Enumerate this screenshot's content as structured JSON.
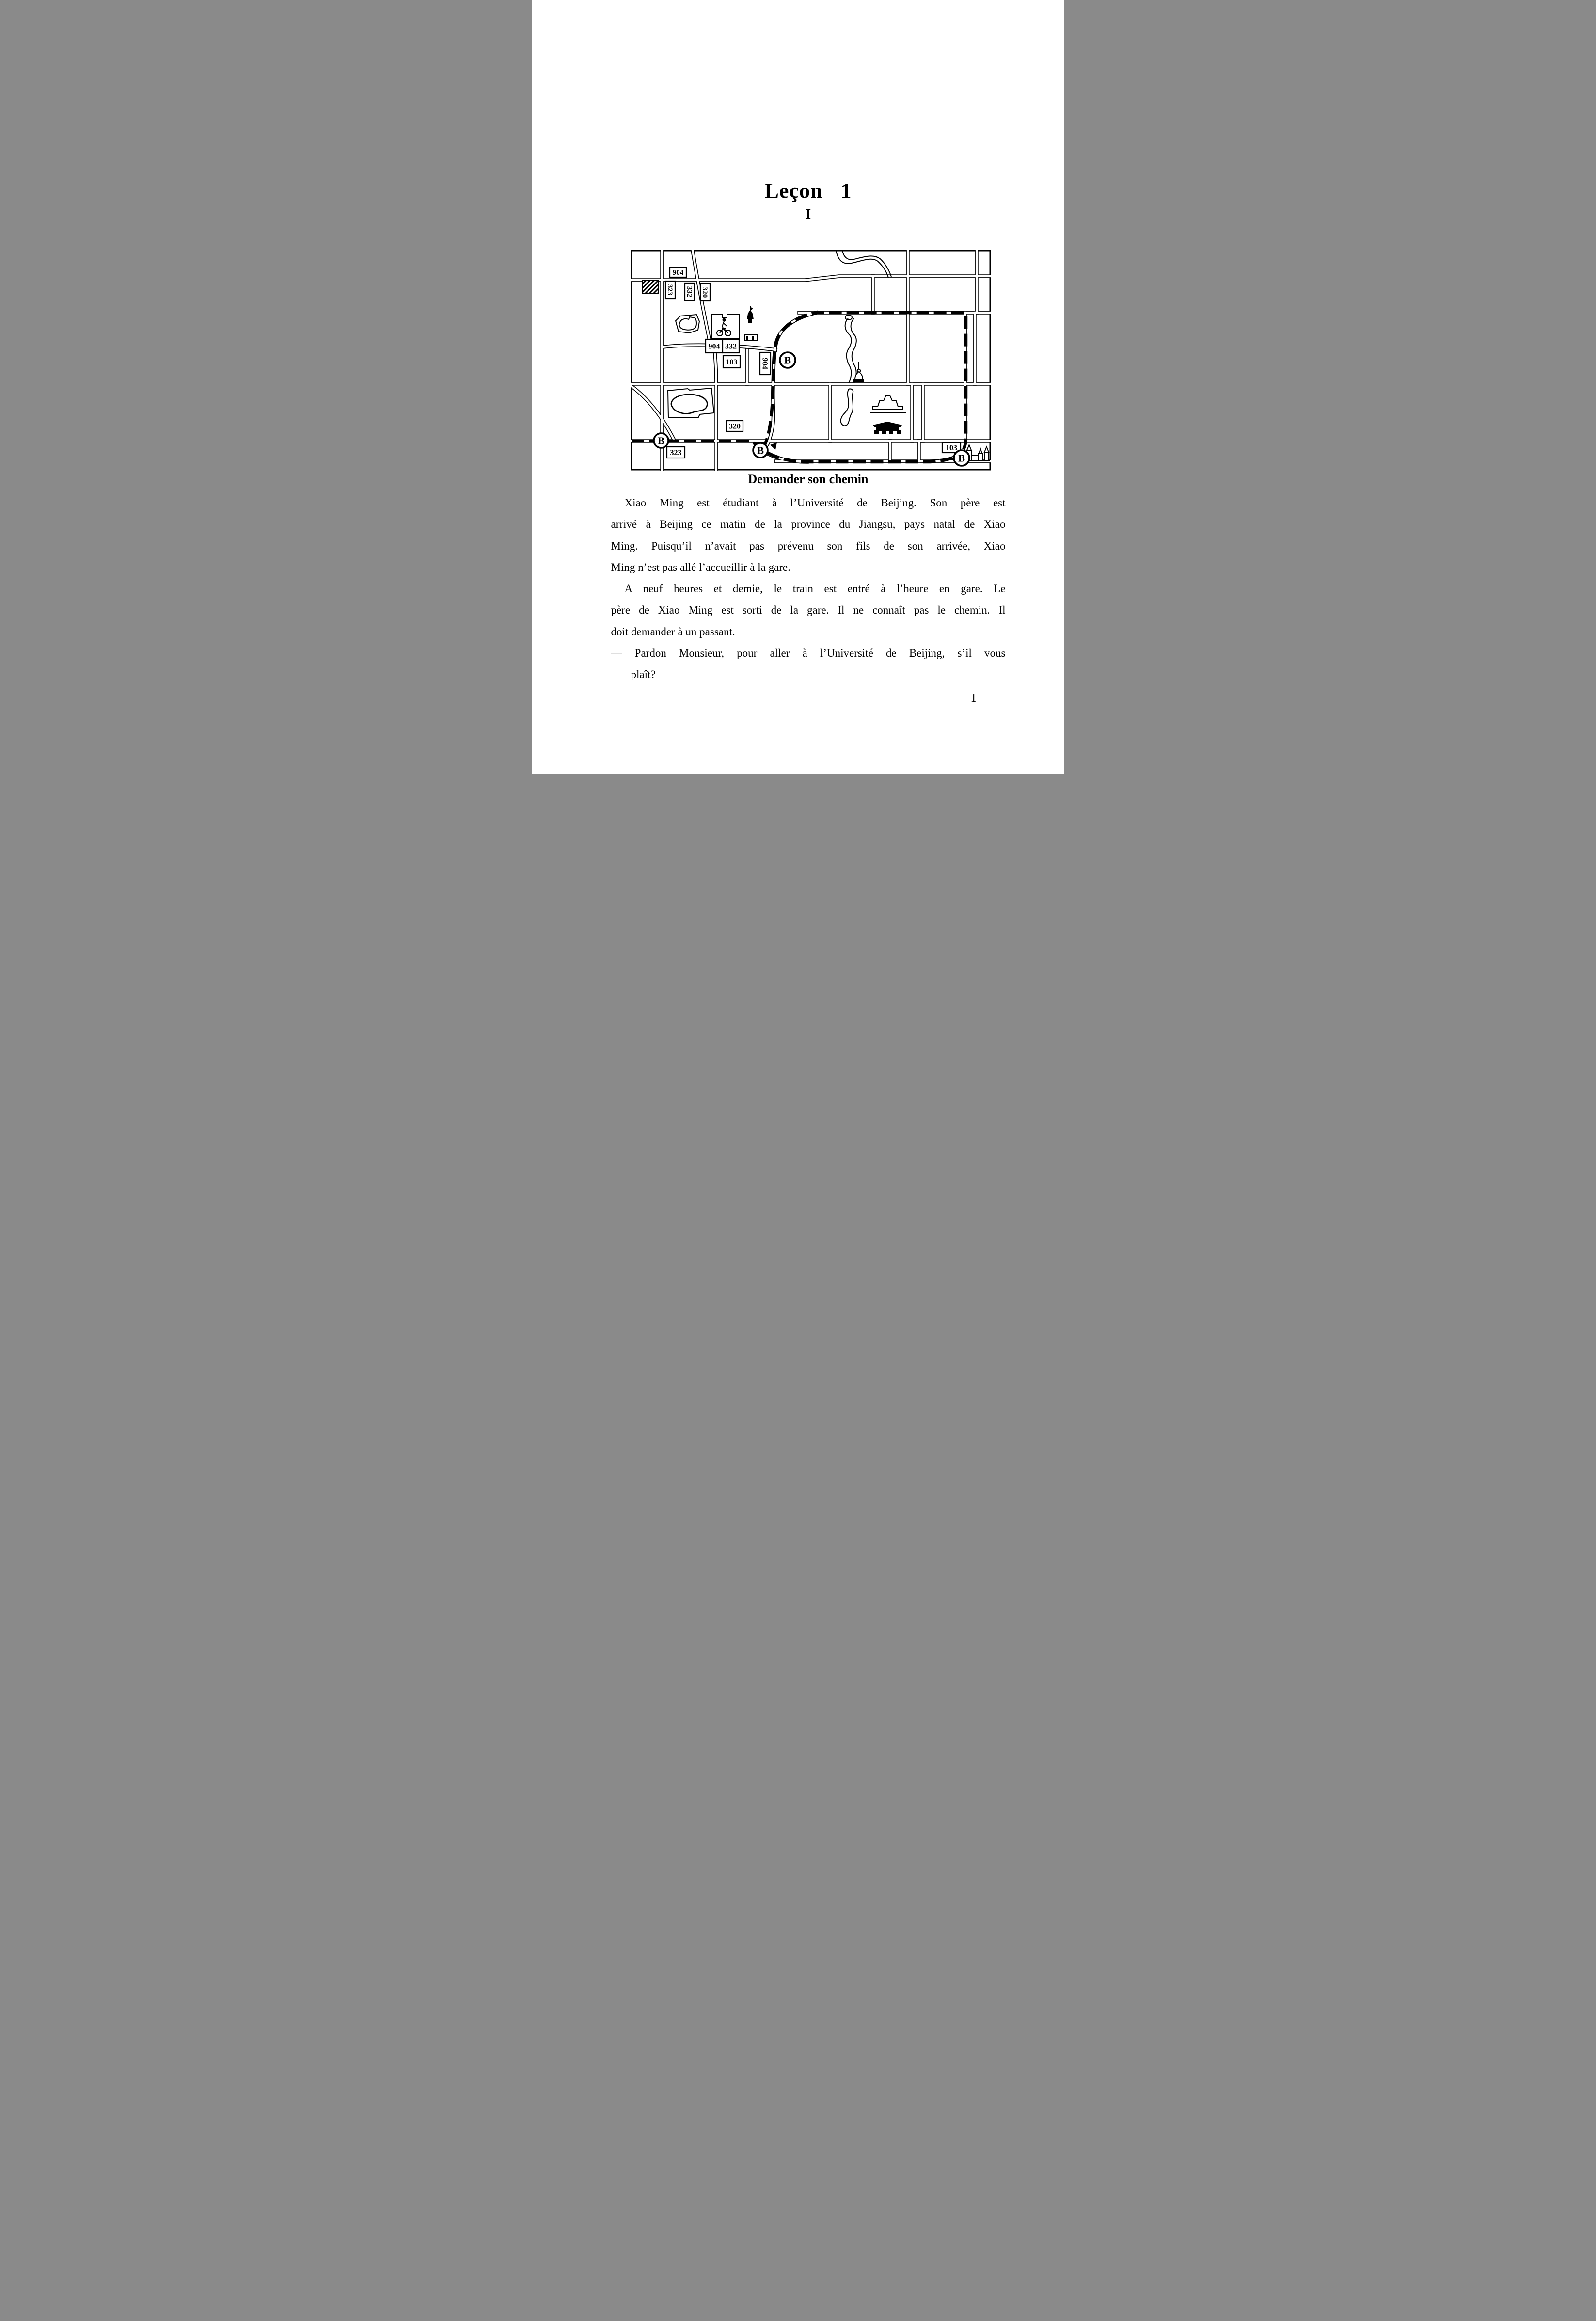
{
  "page": {
    "title": {
      "word": "Leçon",
      "number": "1"
    },
    "section_numeral": "I",
    "map_caption": "Demander son chemin",
    "page_number": "1",
    "body_lines": [
      "Xiao Ming est étudiant à l’Université de Beijing. Son père est",
      "arrivé à Beijing ce matin de la province du Jiangsu, pays natal de Xiao",
      "Ming. Puisqu’il n’avait pas prévenu son fils de son arrivée, Xiao",
      "Ming n’est pas allé l’accueillir à la gare.",
      "A neuf heures et demie, le train est entré à l’heure en gare. Le",
      "père de Xiao Ming est sorti de la gare. Il ne connaît pas le chemin. Il",
      "doit demander à un passant.",
      "— Pardon Monsieur, pour aller à l’Université de Beijing, s’il vous",
      "plaît?"
    ]
  },
  "map": {
    "stop_symbol": "B",
    "labels": {
      "route_904_top": "904",
      "route_323_upper": "323",
      "route_332_upper": "332",
      "route_320_upper": "320",
      "route_904_junction": "904",
      "route_332_junction": "332",
      "route_103_junction": "103",
      "route_904_vertical": "904",
      "route_320_lower": "320",
      "route_323_lower": "323",
      "route_103_station": "103"
    }
  }
}
